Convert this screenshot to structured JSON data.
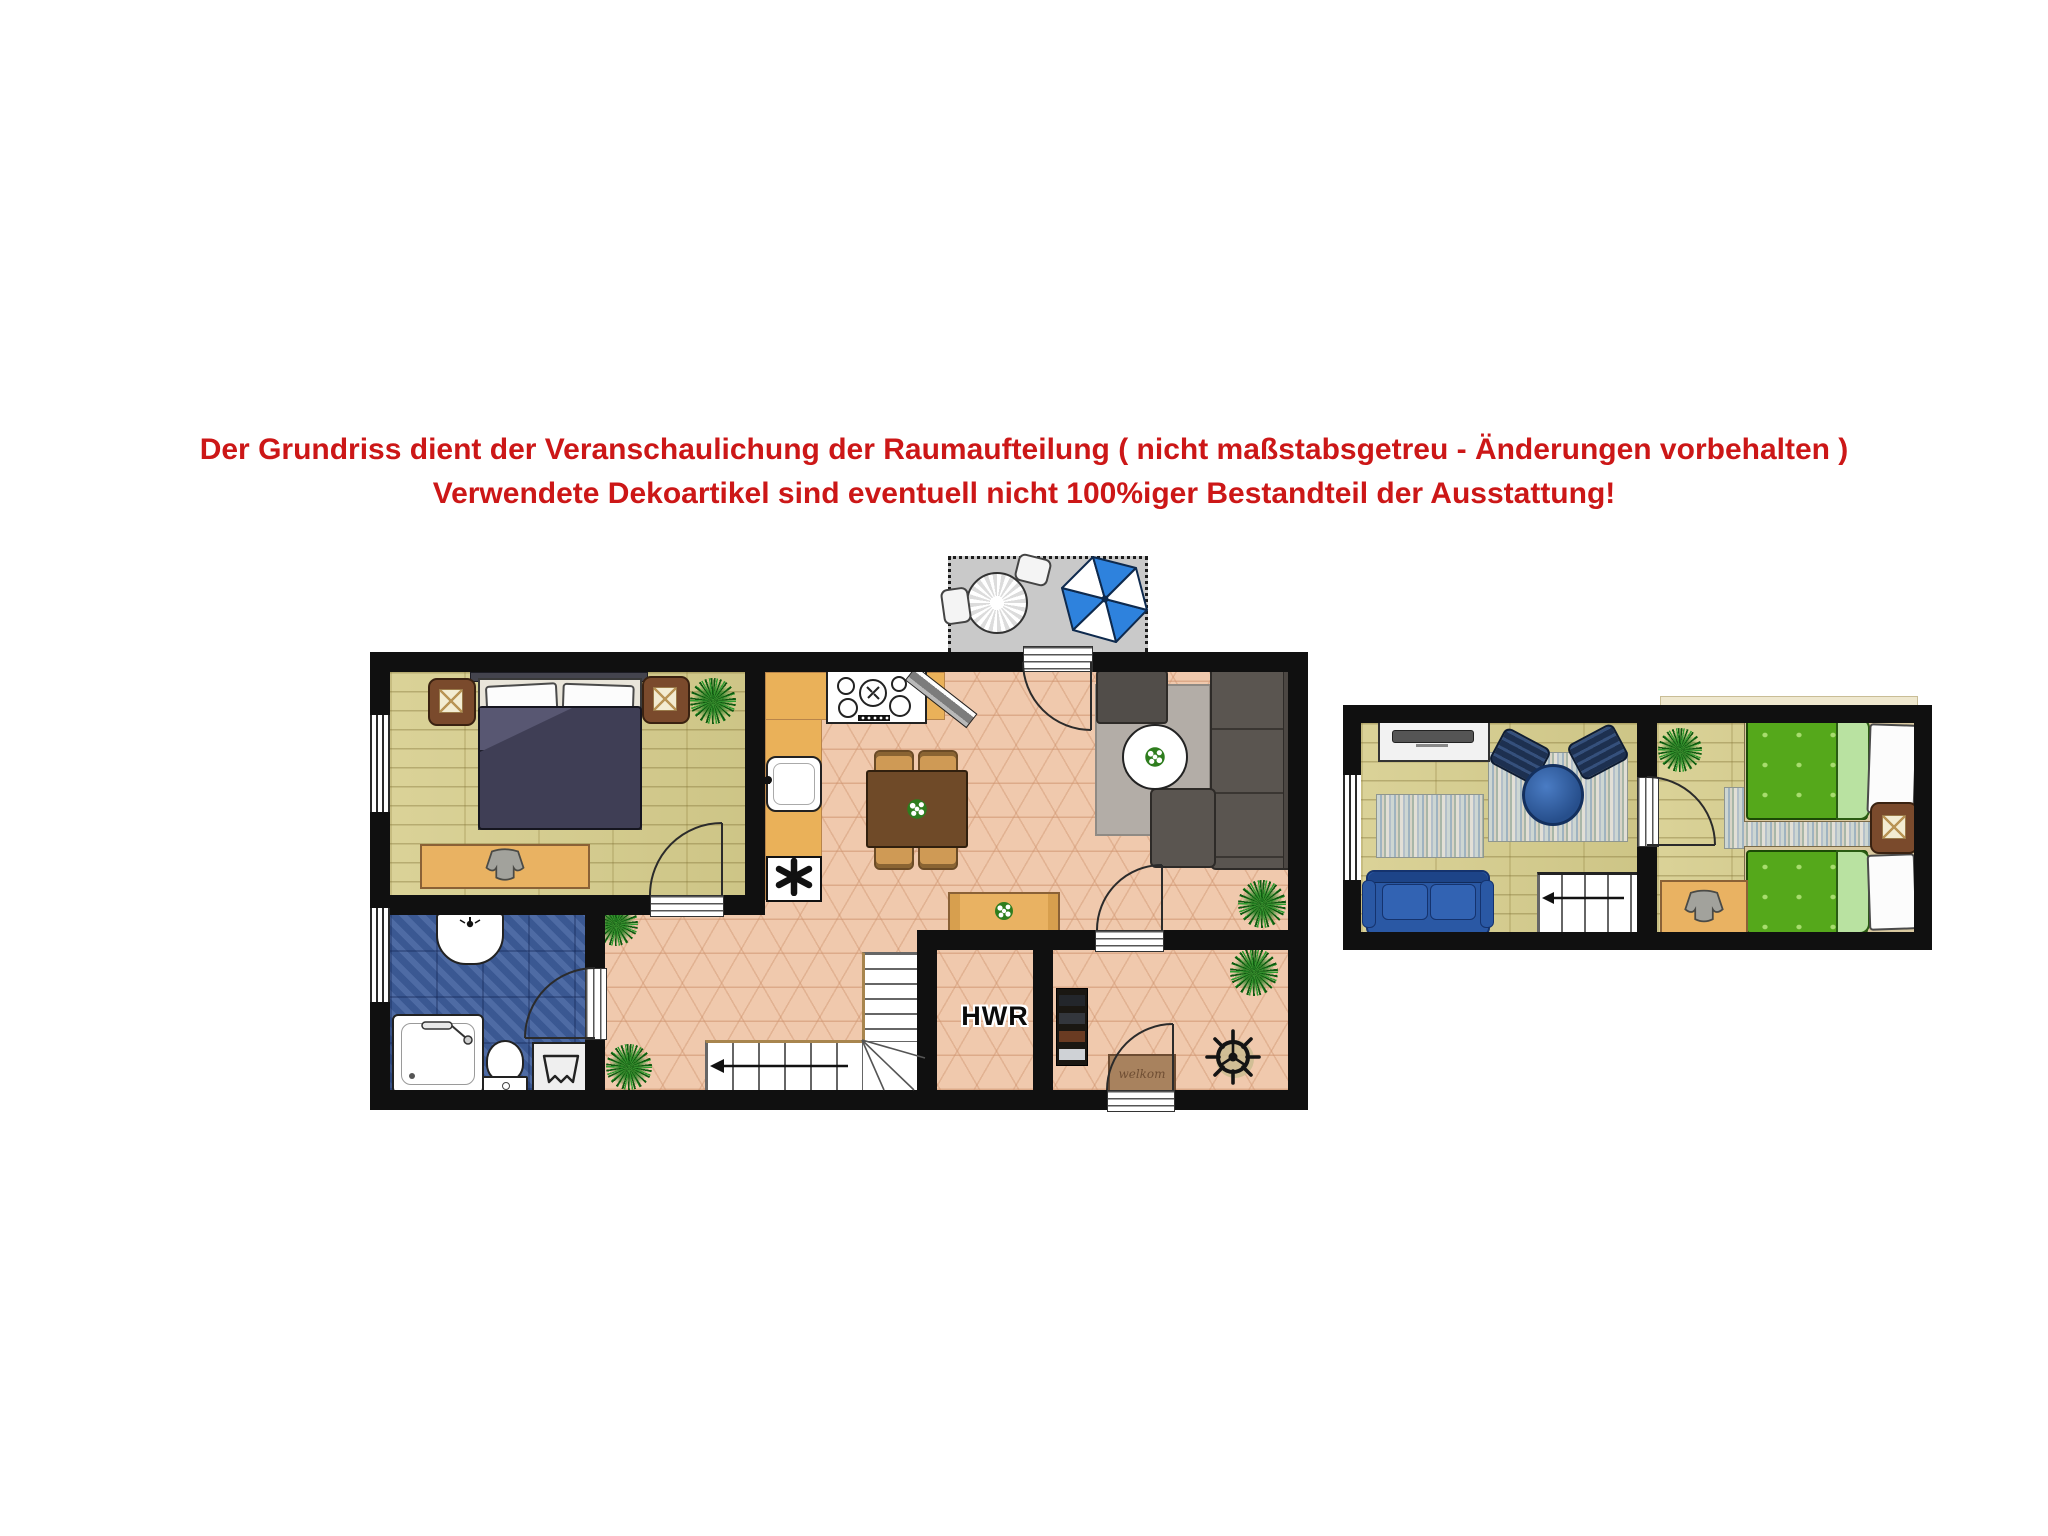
{
  "disclaimer": {
    "line1": "Der Grundriss dient der Veranschaulichung der Raumaufteilung ( nicht maßstabsgetreu - Änderungen vorbehalten )",
    "line2": "Verwendete Dekoartikel sind eventuell nicht 100%iger Bestandteil der Ausstattung!"
  },
  "palette": {
    "accent_red": "#cc1717",
    "wall_black": "#101010",
    "wood_floor": "#d6cd8c",
    "tile_floor": "#f0c9ad",
    "bath_floor": "#41609d",
    "terrace_gray": "#c9c9c9",
    "kitchen_counter": "#eab159",
    "bed_duvet_navy": "#3f3e55",
    "green_bed": "#55a81b",
    "blue_sofa": "#2a58a4",
    "umbrella_blue": "#2e82dd"
  },
  "ground_floor": {
    "labels": {
      "utility_room": "HWR",
      "door_mat": "welkom",
      "appliance_symbol": "*"
    },
    "rooms": [
      "bedroom",
      "bathroom",
      "kitchen-dining",
      "living-area",
      "hallway-stairs",
      "utility-room",
      "entry",
      "terrace"
    ],
    "furniture": [
      "double-bed",
      "nightstand-left",
      "nightstand-right",
      "clothes-bench",
      "bathroom-sink",
      "shower",
      "toilet",
      "laundry-basket",
      "kitchen-counter",
      "stove",
      "kitchen-sink",
      "dishwasher",
      "dining-table",
      "dining-chairs",
      "wall-tv",
      "sectional-sofa",
      "ottoman",
      "coffee-table",
      "area-rug",
      "sideboard",
      "staircase",
      "shoe-rack",
      "ship-wheel",
      "door-mat",
      "patio-table",
      "patio-chairs",
      "parasol",
      "plants"
    ]
  },
  "upper_floor": {
    "rooms": [
      "lounge",
      "bedroom"
    ],
    "furniture": [
      "tv-lowboard",
      "lounge-chairs",
      "round-table",
      "rag-rugs",
      "blue-sofa",
      "staircase",
      "single-bed",
      "single-bed",
      "nightstand",
      "clothes-bench",
      "plant"
    ]
  }
}
